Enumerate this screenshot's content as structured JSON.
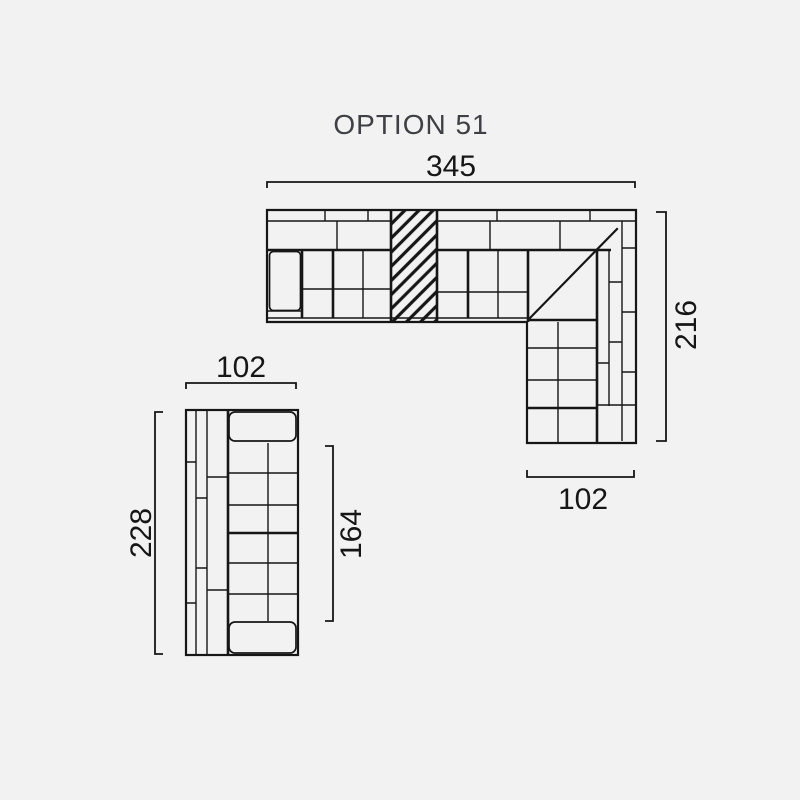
{
  "title": "OPTION 51",
  "colors": {
    "background": "#f2f2f2",
    "line": "#161616",
    "title_text": "#3f4045"
  },
  "dimensions": {
    "sectional_width": "345",
    "sectional_depth": "216",
    "sectional_return": "102",
    "sofa_width": "102",
    "sofa_length": "228",
    "sofa_seat": "164"
  }
}
